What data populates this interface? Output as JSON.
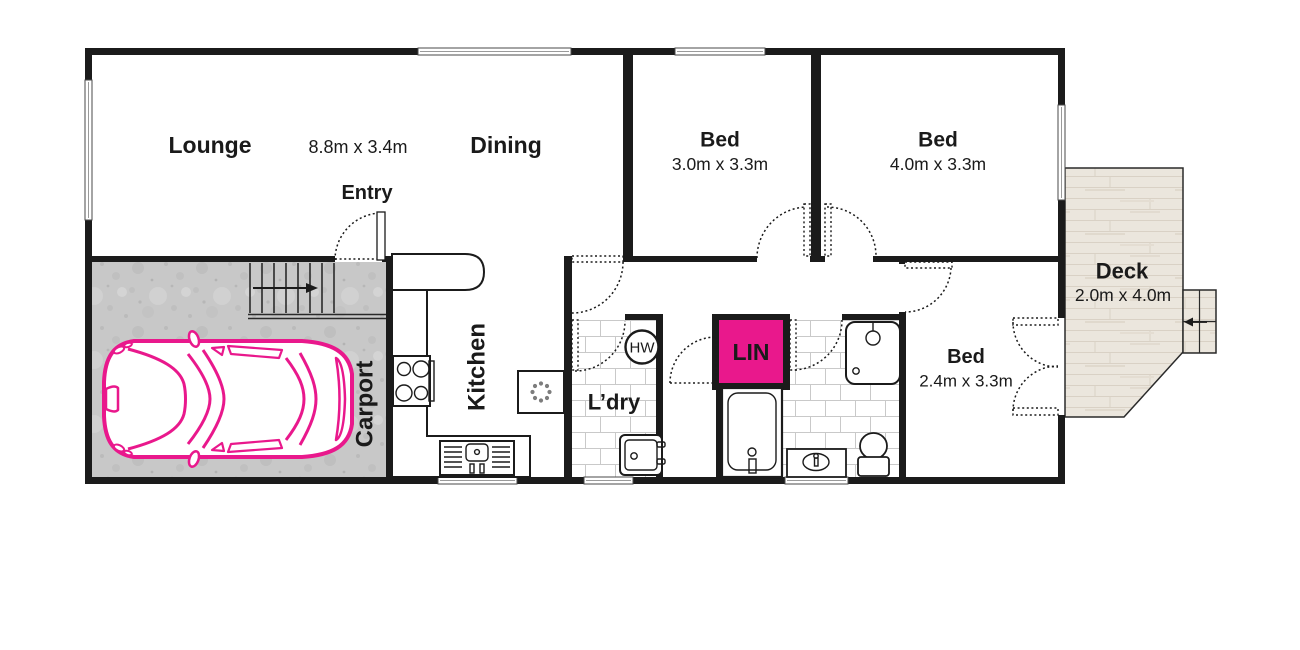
{
  "title": "House floor plan",
  "colors": {
    "accent_pink": "#e9188c",
    "wall": "#1b1b1b",
    "concrete": "#c8c8c8",
    "deck_wood": "#ebe6dd",
    "tile_line": "#c9c9c9"
  },
  "rooms": {
    "lounge": {
      "name": "Lounge"
    },
    "dining": {
      "name": "Dining"
    },
    "lounge_dining_dims": "8.8m x 3.4m",
    "entry": {
      "name": "Entry"
    },
    "bed1": {
      "name": "Bed",
      "dims": "3.0m x 3.3m"
    },
    "bed2": {
      "name": "Bed",
      "dims": "4.0m x 3.3m"
    },
    "bed3": {
      "name": "Bed",
      "dims": "2.4m x 3.3m"
    },
    "deck": {
      "name": "Deck",
      "dims": "2.0m x 4.0m"
    },
    "kitchen": {
      "name": "Kitchen"
    },
    "laundry": {
      "name": "L’dry"
    },
    "carport": {
      "name": "Carport"
    },
    "linen": {
      "name": "LIN"
    },
    "hot_water": {
      "name": "HW"
    }
  },
  "fixtures": [
    "car",
    "stairs",
    "entry-door",
    "stove",
    "kitchen-counter",
    "kitchen-sink",
    "fan-appliance",
    "hot-water-unit",
    "laundry-trough",
    "bath",
    "shower",
    "vanity",
    "toilet",
    "deck-steps",
    "french-doors"
  ]
}
